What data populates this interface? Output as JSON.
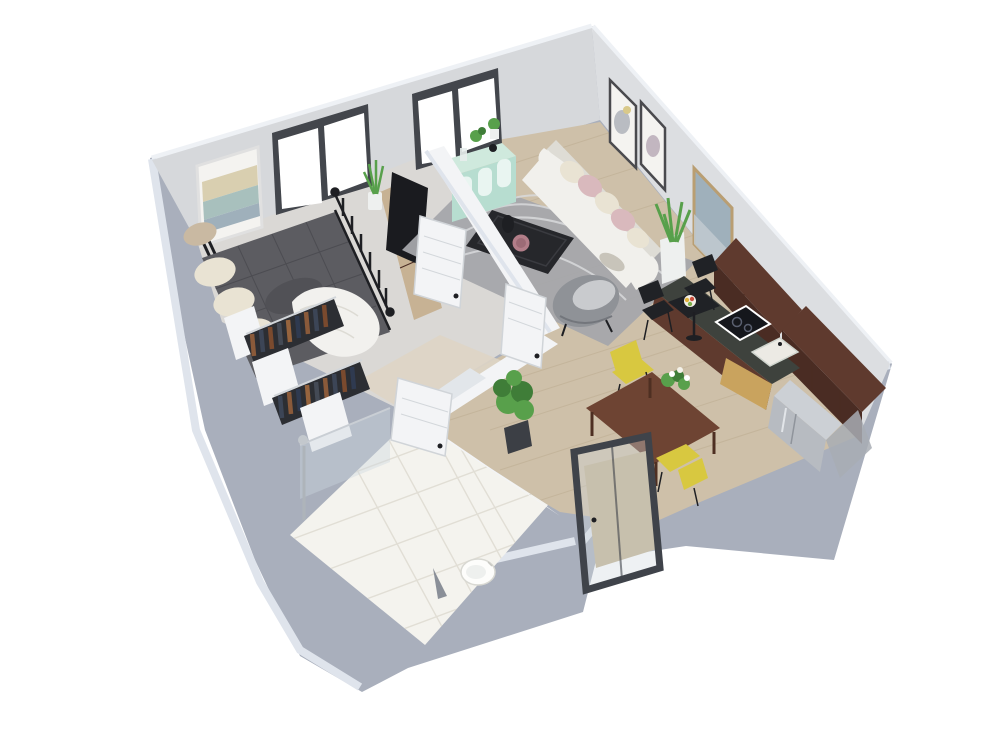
{
  "meta": {
    "description": "3D isometric rendered floor plan of a one-bedroom apartment on a white background",
    "canvas": {
      "width": 1000,
      "height": 750
    }
  },
  "colors": {
    "white": "#ffffff",
    "wall_ext": "#a9afbc",
    "wall_ext_dark": "#99a0ae",
    "wallcap": "#eef1f5",
    "wallcap_blue": "#dfe4ec",
    "wall_nw": "#d6d8db",
    "wall_ne": "#dcdee1",
    "partition": "#f3f4f6",
    "partition_shade": "#e2e6ea",
    "floor_wood": "#cec0a9",
    "floor_wood_line": "#bcab90",
    "floor_bedroom": "#dad8d5",
    "floor_hall": "#ded5c5",
    "floor_bath": "#f4f3ee",
    "tile_line": "#e1ded5",
    "rug": "#a5a7ab",
    "rug_swirl": "#d9dadc",
    "bed": "#5c5c61",
    "bed_tuft": "#47474c",
    "bolster": "#515156",
    "pillow_cream": "#e9e3d3",
    "pillow_tan": "#c9b9a2",
    "blanket": "#f2f1ee",
    "metal": "#1e1f23",
    "rail_dark": "#2c2e33",
    "rod": "#d2d6da",
    "clothes_brown": "#8a5a3a",
    "clothes_navy": "#3c4556",
    "tv": "#1a1b1f",
    "tv_unit": "#c7b294",
    "console": "#cfe9dd",
    "console_front": "#b7ddd0",
    "console_panel": "#e9f5f1",
    "sofa": "#f1f0ec",
    "sofa_shade": "#dedcd5",
    "blush": "#d9b9bd",
    "armchair": "#8f9297",
    "armchair_light": "#c9cbce",
    "coffee_table": "#26272b",
    "bowl": "#b27e89",
    "green": "#58a04b",
    "green_dark": "#3f7d38",
    "planter": "#eef0ef",
    "pot_dark": "#3c3f45",
    "frame_dark": "#43464c",
    "frame_wood": "#b99e72",
    "art_paper": "#f4f3f0",
    "art_teal": "#a8c0bd",
    "art_sand": "#d9cfb0",
    "art_blue": "#9fb0bb",
    "bistro": "#202226",
    "dining": "#6e4433",
    "yellow": "#d8c840",
    "counter": "#3e423d",
    "walnut": "#5f3a2e",
    "walnut_dark": "#4a2c23",
    "gold": "#c9a35e",
    "cooktop": "#15171c",
    "sink": "#eceae4",
    "fridge": "#b7bbc1",
    "fridge_top": "#ccd0d5",
    "door_frame": "#3f434a",
    "door_edge": "#d3d7db",
    "glass": "#cdd6de",
    "glass_line": "#c9ced4",
    "porch": "#c4b494",
    "toilet": "#fdfdfb"
  },
  "scene": {
    "type": "3d-floor-plan-render",
    "view": "isometric-top",
    "background": "white",
    "rooms": [
      {
        "name": "bedroom",
        "items": [
          "double-bed-dark-gray-tufted",
          "black-metal-bed-frame",
          "cream-pillows",
          "white-throw-blanket",
          "wardrobe-closet-hanging-clothes-2-rails",
          "tv-on-wood-media-unit",
          "snake-plant",
          "abstract-beach-wall-art",
          "window-dark-frame"
        ]
      },
      {
        "name": "living-room",
        "items": [
          "white-sofa-blush-pillows",
          "gray-swirl-rug",
          "black-coffee-table-with-bottle-and-bowl",
          "gray-armchair",
          "mint-green-sideboard-console",
          "tall-potted-plant",
          "two-small-framed-prints",
          "large-framed-art",
          "window-dark-frame"
        ]
      },
      {
        "name": "kitchen",
        "items": [
          "walnut-base-cabinets",
          "walnut-upper-cabinets",
          "induction-cooktop",
          "kitchen-sink",
          "stainless-refrigerator",
          "black-bistro-table",
          "two-black-chairs",
          "fruit-bowl"
        ]
      },
      {
        "name": "dining-area",
        "items": [
          "walnut-dining-table",
          "two-yellow-chairs",
          "white-flower-centerpiece",
          "glass-entry-door-dark-frame"
        ]
      },
      {
        "name": "bathroom",
        "items": [
          "white-tile-floor",
          "walk-in-shower-glass",
          "round-toilet",
          "potted-plant-at-hall"
        ]
      },
      {
        "name": "hallway",
        "items": [
          "three-white-interior-doors"
        ]
      }
    ]
  }
}
